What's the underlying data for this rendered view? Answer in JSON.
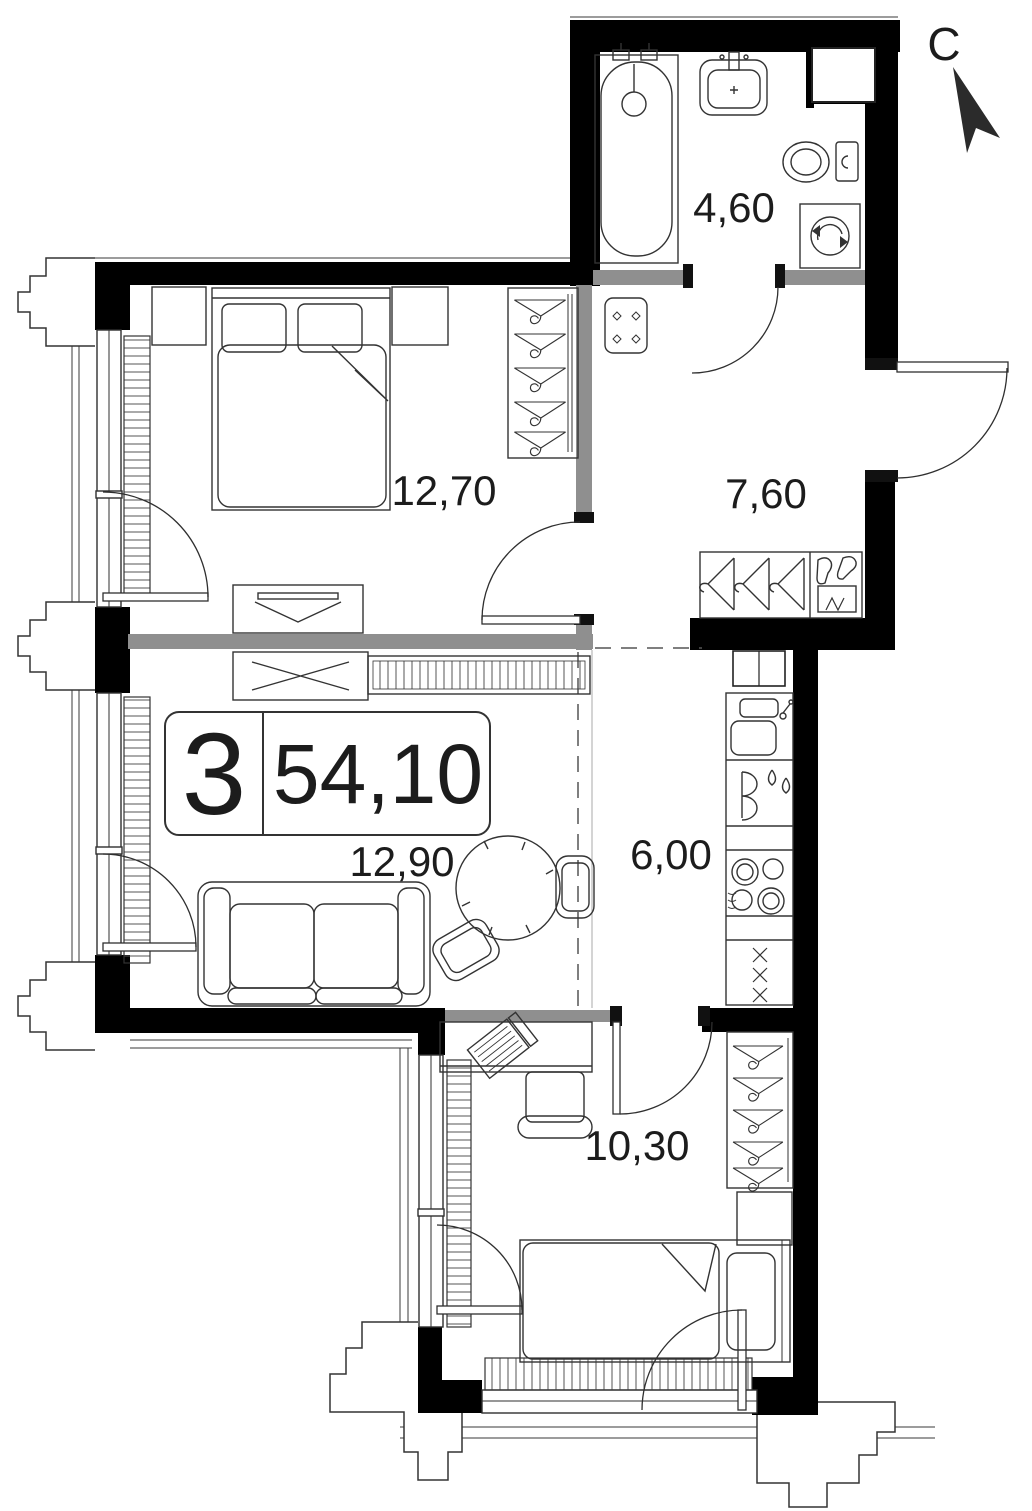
{
  "plan": {
    "title": "apartment-floor-plan",
    "apartment": {
      "number": "3",
      "total_area": "54,10"
    },
    "compass": {
      "letter": "С",
      "icon": "north-arrow-icon"
    },
    "rooms": [
      {
        "id": "bathroom",
        "area": "4,60"
      },
      {
        "id": "bedroom",
        "area": "12,70"
      },
      {
        "id": "hallway",
        "area": "7,60"
      },
      {
        "id": "living-room",
        "area": "12,90"
      },
      {
        "id": "kitchen",
        "area": "6,00"
      },
      {
        "id": "bedroom-2",
        "area": "10,30"
      }
    ],
    "furniture_icons": [
      "bathtub-icon",
      "washbasin-icon",
      "toilet-icon",
      "washing-machine-icon",
      "double-bed-icon",
      "nightstand-icon",
      "wardrobe-hangers-icon",
      "dresser-icon",
      "sofa-icon",
      "round-table-icon",
      "chair-icon",
      "hallway-closet-icon",
      "kitchen-sink-icon",
      "fridge-icon",
      "stove-icon",
      "kitchen-cabinet-icon",
      "desk-laptop-icon",
      "single-bed-icon",
      "radiator-icon"
    ],
    "colors": {
      "wall": "#000000",
      "partition": "#8f8f8f",
      "line": "#2f2f2f"
    }
  }
}
